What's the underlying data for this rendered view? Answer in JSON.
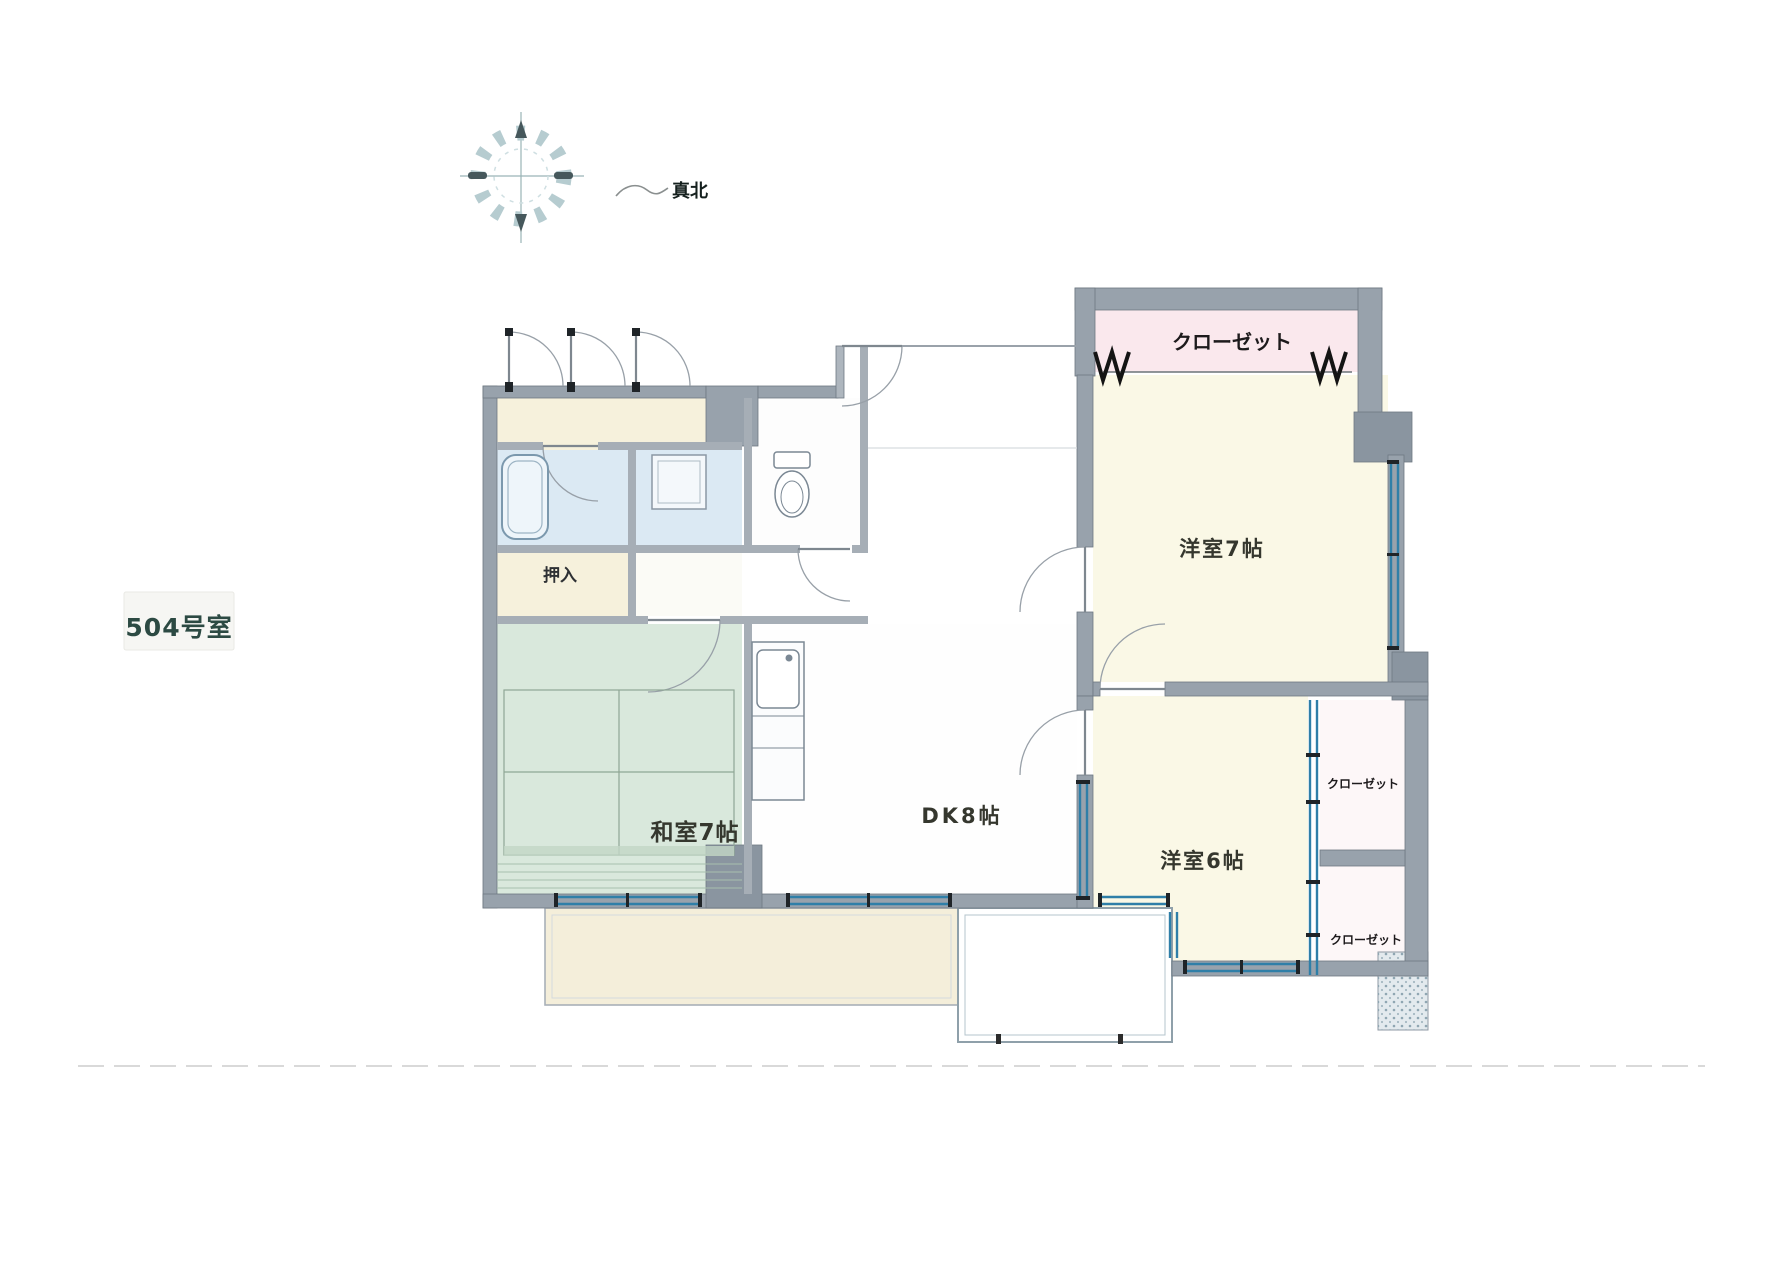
{
  "labels": {
    "north": "真北",
    "unit": "504号室"
  },
  "rooms": {
    "closet_top": "クローゼット",
    "western_7": "洋室7帖",
    "western_6": "洋室6帖",
    "dining_kitchen": "DK8帖",
    "japanese_7": "和室7帖",
    "oshiire": "押入",
    "closet_right_upper": "クローゼット",
    "closet_right_lower": "クローゼット"
  },
  "colors": {
    "wall_gray": "#98a2ac",
    "window_teal": "#2f7fa8",
    "tatami_green": "#d9e8dc",
    "room_cream": "#faf8e6",
    "closet_pink": "#fae8ed",
    "bath_blue": "#dbe9f3",
    "balcony_tan": "#f4eeda",
    "unit_label_teal": "#2c4a43",
    "compass_light": "#b6ccd0",
    "compass_dark": "#46585c"
  }
}
